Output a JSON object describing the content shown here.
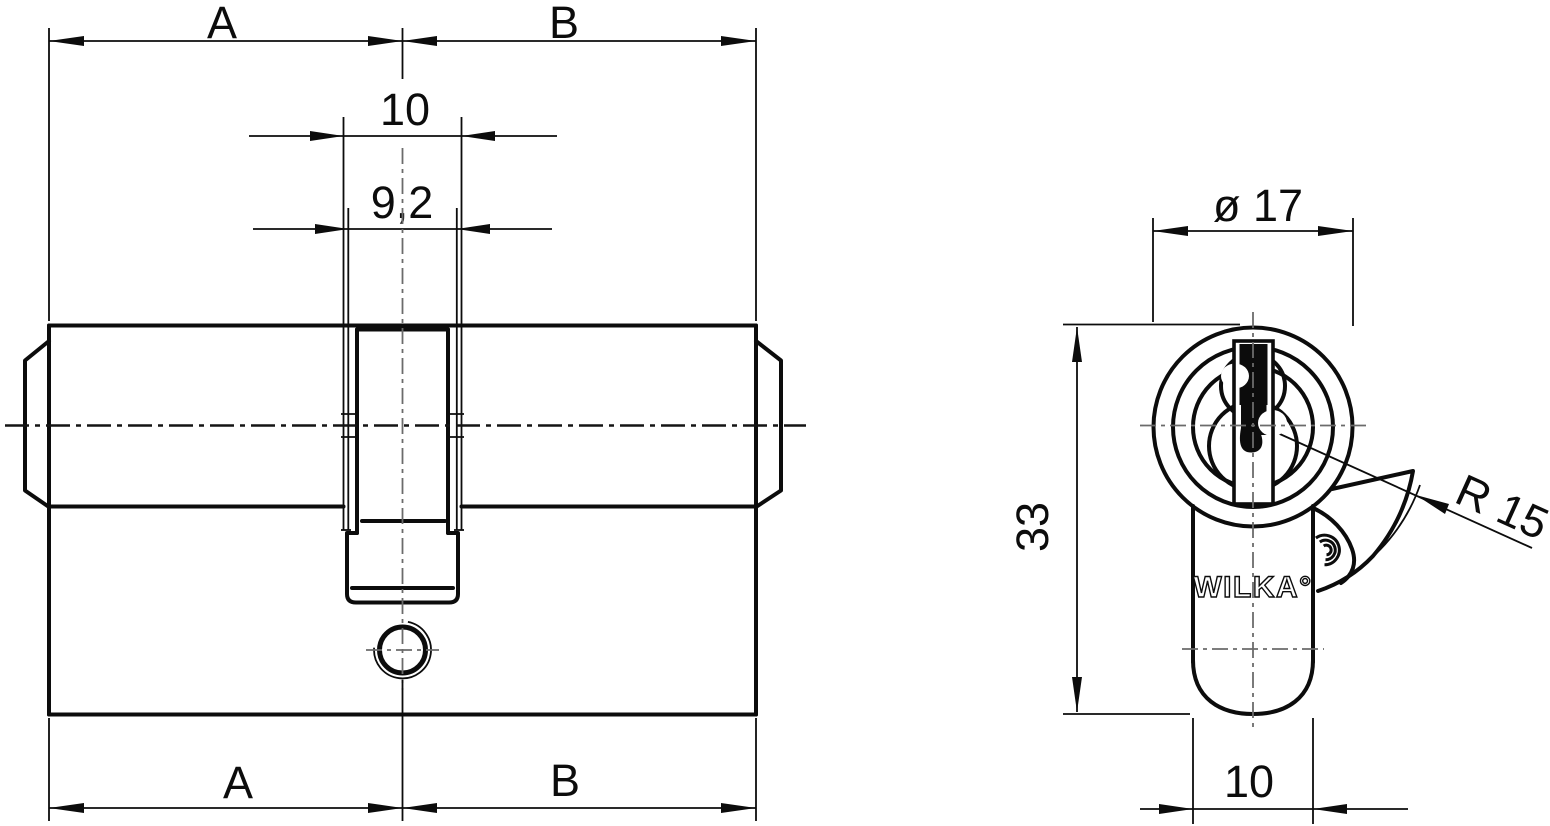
{
  "title": "WILKA double profile cylinder technical drawing",
  "colors": {
    "line": "#0c0c0c",
    "background": "#ffffff",
    "centerline": "#6b6b6b"
  },
  "side_view": {
    "dim_a": "A",
    "dim_b": "B",
    "dim_cam_width": "10",
    "dim_cam_inner": "9,2"
  },
  "front_view": {
    "dim_diameter": "ø 17",
    "dim_height": "33",
    "dim_radius": "R 15",
    "dim_foot_width": "10",
    "brand": "WILKA°"
  }
}
